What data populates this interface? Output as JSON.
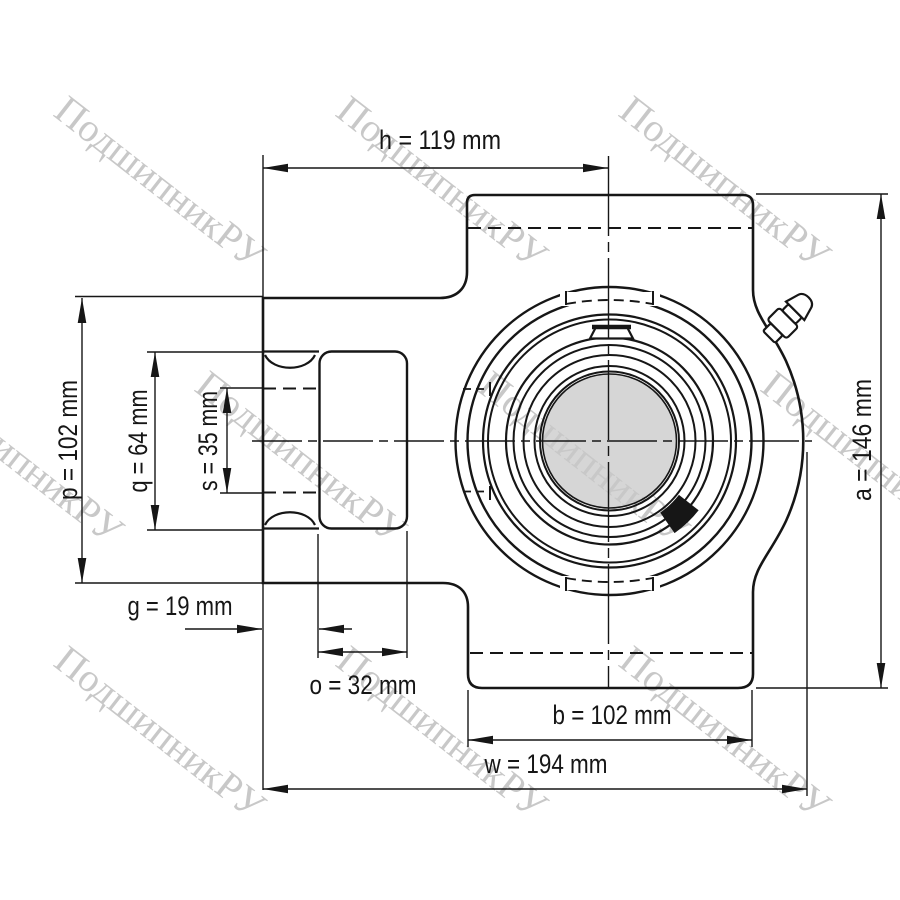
{
  "drawing": {
    "kind": "take-up bearing unit technical drawing",
    "watermark": {
      "text": "ПодшипникРУ",
      "color": "#c8c8c8"
    },
    "colors": {
      "line": "#161616",
      "bore_fill": "#d6d6d6",
      "background": "#ffffff"
    },
    "dimensions": {
      "h": {
        "param": "h",
        "value": 119,
        "unit": "mm",
        "label": "h = 119 mm"
      },
      "p": {
        "param": "p",
        "value": 102,
        "unit": "mm",
        "label": "p = 102 mm"
      },
      "q": {
        "param": "q",
        "value": 64,
        "unit": "mm",
        "label": "q = 64 mm"
      },
      "s": {
        "param": "s",
        "value": 35,
        "unit": "mm",
        "label": "s = 35 mm"
      },
      "g": {
        "param": "g",
        "value": 19,
        "unit": "mm",
        "label": "g = 19 mm"
      },
      "o": {
        "param": "o",
        "value": 32,
        "unit": "mm",
        "label": "o  = 32 mm"
      },
      "b": {
        "param": "b",
        "value": 102,
        "unit": "mm",
        "label": "b = 102 mm"
      },
      "w": {
        "param": "w",
        "value": 194,
        "unit": "mm",
        "label": "w = 194 mm"
      },
      "a": {
        "param": "a",
        "value": 146,
        "unit": "mm",
        "label": "a = 146 mm"
      }
    }
  }
}
